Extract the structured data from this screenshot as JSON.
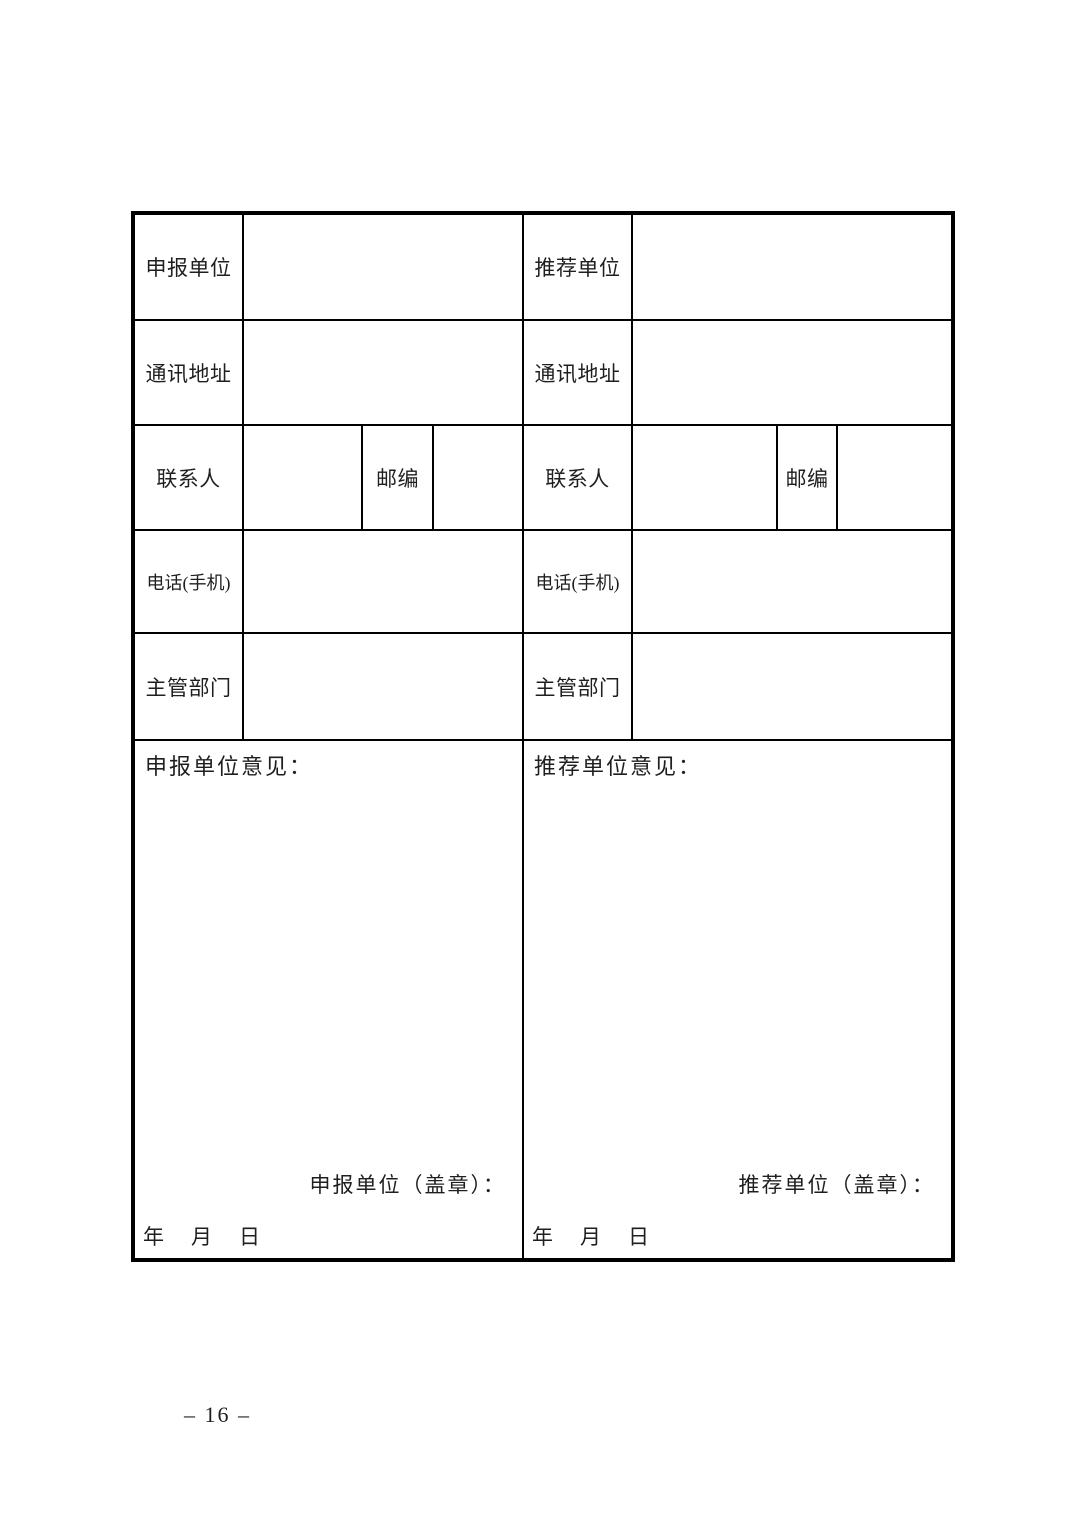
{
  "colors": {
    "ink": "#1f1f1f",
    "border": "#000000",
    "paper": "#ffffff"
  },
  "page": {
    "page_number": "– 16 –"
  },
  "form": {
    "left": {
      "unit_label": "申报单位",
      "address_label": "通讯地址",
      "contact_label": "联系人",
      "postcode_label": "邮编",
      "phone_label": "电话(手机)",
      "department_label": "主管部门",
      "opinion_label": "申报单位意见：",
      "seal_label": "申报单位（盖章）：",
      "date_label": "年　月　日"
    },
    "right": {
      "unit_label": "推荐单位",
      "address_label": "通讯地址",
      "contact_label": "联系人",
      "postcode_label": "邮编",
      "phone_label": "电话(手机)",
      "department_label": "主管部门",
      "opinion_label": "推荐单位意见：",
      "seal_label": "推荐单位（盖章）：",
      "date_label": "年　月　日"
    }
  }
}
